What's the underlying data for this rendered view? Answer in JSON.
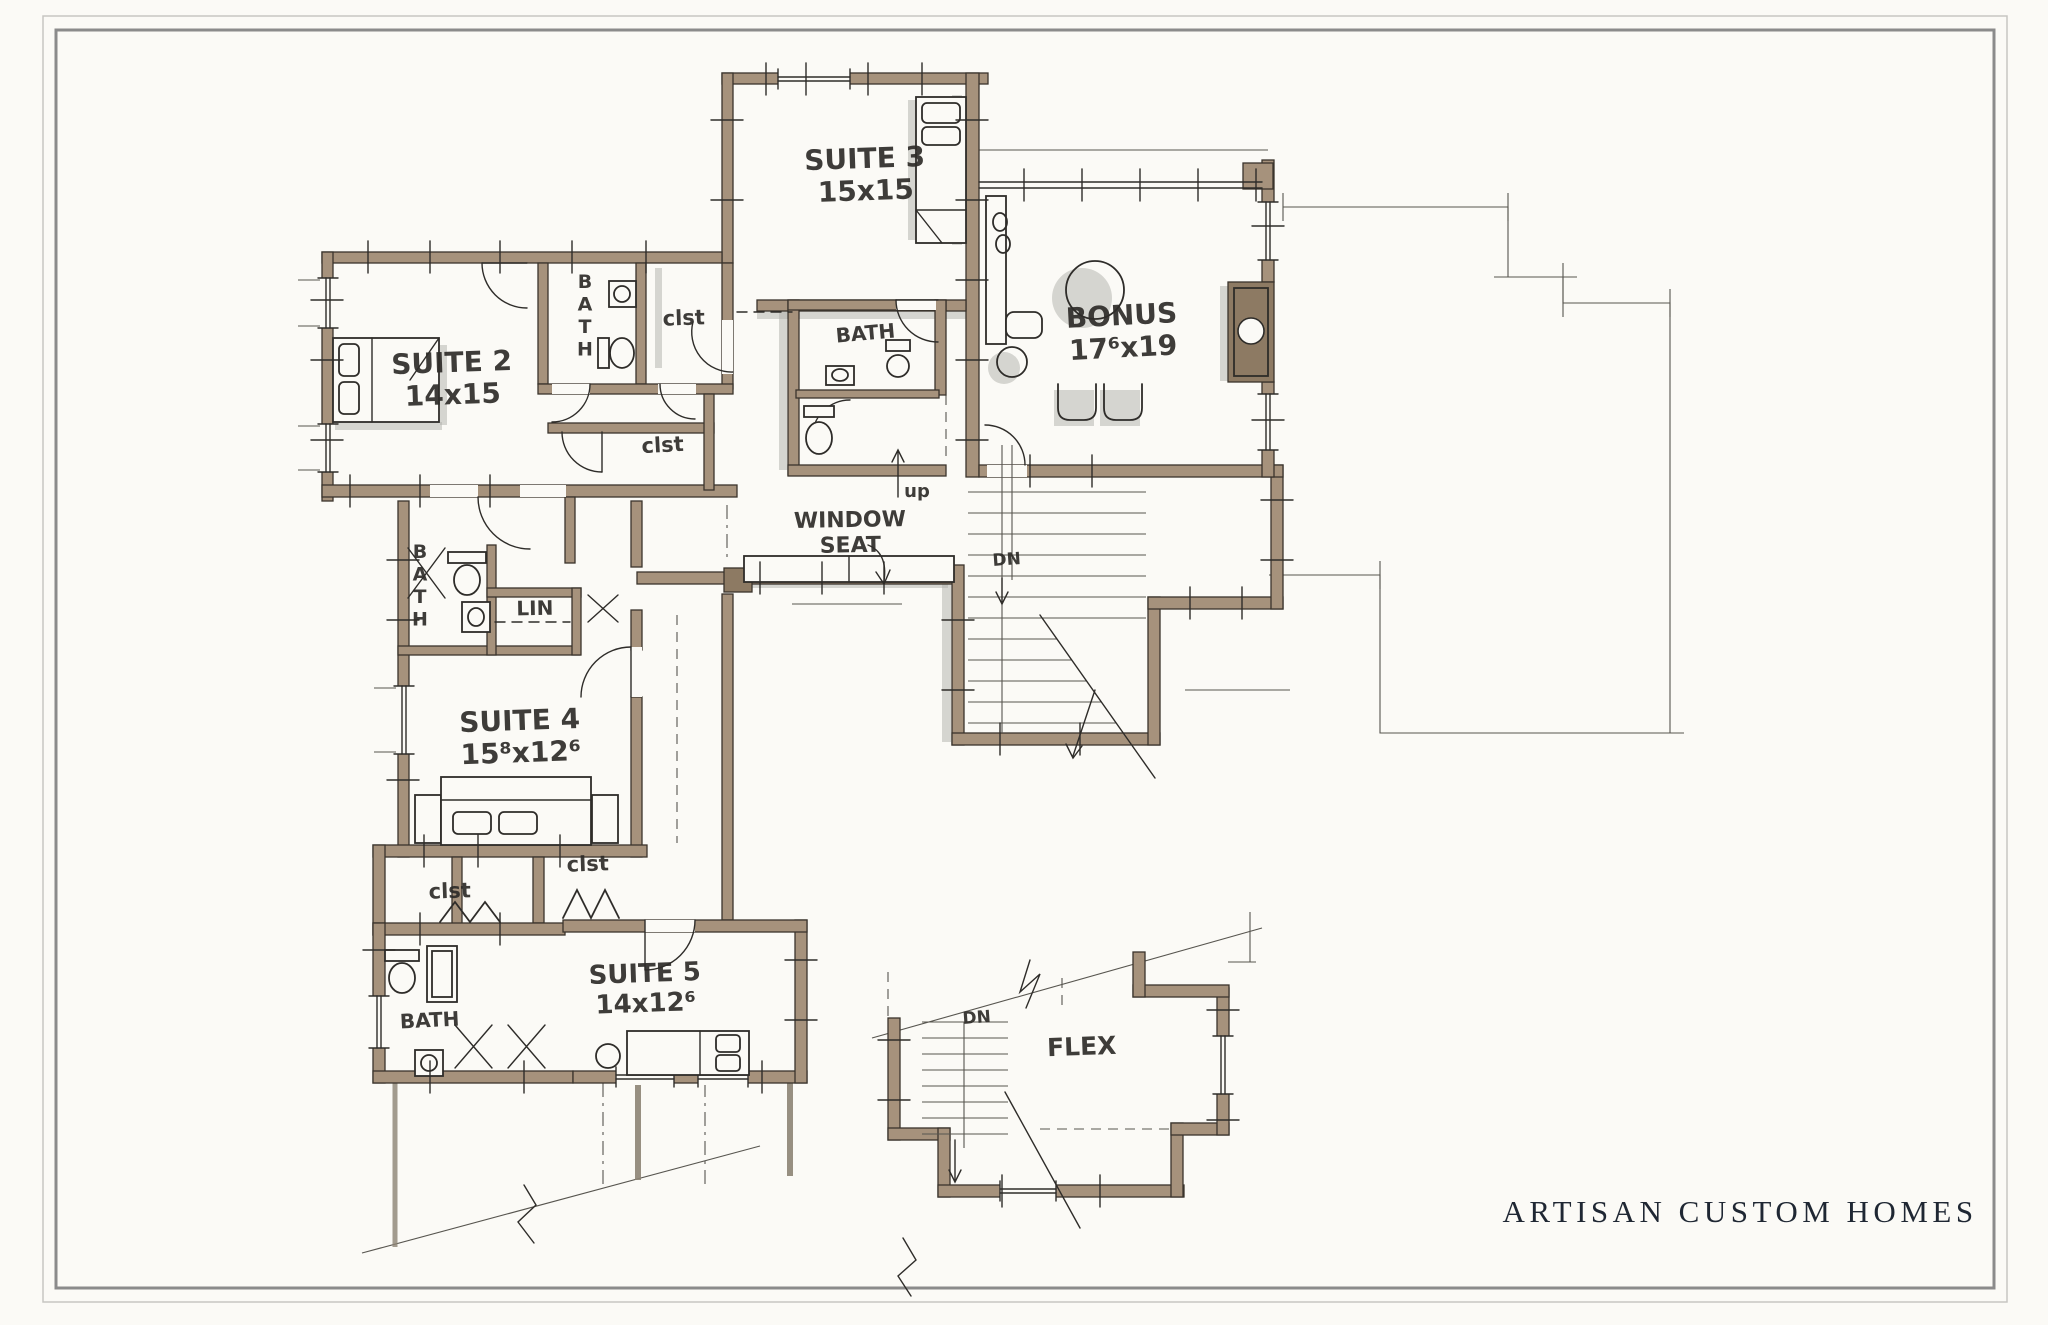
{
  "meta": {
    "sheet_width": 2048,
    "sheet_height": 1325,
    "drawing_type": "hand-drawn floor plan"
  },
  "colors": {
    "paper": "#fbfaf6",
    "ink": "#2e2c29",
    "wall": "#a6927c",
    "wall_dark": "#8d7a63",
    "shadow": "#b0afaa",
    "thin": "#57554f",
    "brand": "#1f2733",
    "frame": "#8b8b8b"
  },
  "brand": {
    "text": "ARTISAN CUSTOM HOMES"
  },
  "rooms": [
    {
      "id": "suite-2",
      "name": "SUITE 2",
      "dims": "14x15"
    },
    {
      "id": "suite-3",
      "name": "SUITE 3",
      "dims": "15x15"
    },
    {
      "id": "bonus",
      "name": "BONUS",
      "dims": "17⁶x19"
    },
    {
      "id": "suite-4",
      "name": "SUITE 4",
      "dims": "15⁸x12⁶"
    },
    {
      "id": "suite-5",
      "name": "SUITE 5",
      "dims": "14x12⁶"
    },
    {
      "id": "flex",
      "name": "FLEX",
      "dims": ""
    }
  ],
  "labels": [
    {
      "id": "suite-3-name",
      "lines": [
        "SUITE 3",
        "15x15"
      ],
      "x": 865,
      "y": 168,
      "size": 28,
      "rotate": -2
    },
    {
      "id": "suite-2-name",
      "lines": [
        "SUITE 2",
        "14x15"
      ],
      "x": 452,
      "y": 372,
      "size": 28,
      "rotate": -2
    },
    {
      "id": "bonus-name",
      "lines": [
        "BONUS",
        "17⁶x19"
      ],
      "x": 1122,
      "y": 325,
      "size": 28,
      "rotate": -3
    },
    {
      "id": "suite-4-name",
      "lines": [
        "SUITE 4",
        "15⁸x12⁶"
      ],
      "x": 520,
      "y": 730,
      "size": 28,
      "rotate": -2
    },
    {
      "id": "suite-5-name",
      "lines": [
        "SUITE 5",
        "14x12⁶"
      ],
      "x": 645,
      "y": 982,
      "size": 26,
      "rotate": -2
    },
    {
      "id": "flex-name",
      "text": "FLEX",
      "x": 1082,
      "y": 1055,
      "size": 25,
      "rotate": -2
    },
    {
      "id": "window-seat",
      "lines": [
        "WINDOW",
        "SEAT"
      ],
      "x": 850,
      "y": 527,
      "size": 22,
      "rotate": -1
    },
    {
      "id": "bath-top",
      "text": "BATH",
      "x": 585,
      "y": 288,
      "size": 19,
      "vertical": true
    },
    {
      "id": "bath-left",
      "text": "BATH",
      "x": 420,
      "y": 558,
      "size": 19,
      "vertical": true
    },
    {
      "id": "bath-mid",
      "text": "BATH",
      "x": 866,
      "y": 340,
      "size": 20,
      "rotate": -5
    },
    {
      "id": "bath-bottom",
      "text": "BATH",
      "x": 430,
      "y": 1027,
      "size": 20,
      "rotate": -3
    },
    {
      "id": "clst-top",
      "text": "clst",
      "x": 684,
      "y": 325,
      "size": 21,
      "rotate": -2
    },
    {
      "id": "clst-mid",
      "text": "clst",
      "x": 663,
      "y": 452,
      "size": 21,
      "rotate": -3
    },
    {
      "id": "clst-bottom-left",
      "text": "clst",
      "x": 450,
      "y": 898,
      "size": 21,
      "rotate": -2
    },
    {
      "id": "clst-bottom-right",
      "text": "clst",
      "x": 588,
      "y": 871,
      "size": 21,
      "rotate": -2
    },
    {
      "id": "lin",
      "text": "LIN",
      "x": 535,
      "y": 615,
      "size": 20,
      "rotate": -1
    },
    {
      "id": "up",
      "text": "up",
      "x": 917,
      "y": 497,
      "size": 18,
      "rotate": 0
    },
    {
      "id": "dn-main",
      "text": "DN",
      "x": 1007,
      "y": 565,
      "size": 17,
      "rotate": -4
    },
    {
      "id": "dn-flex",
      "text": "DN",
      "x": 977,
      "y": 1023,
      "size": 17,
      "rotate": -4
    }
  ]
}
